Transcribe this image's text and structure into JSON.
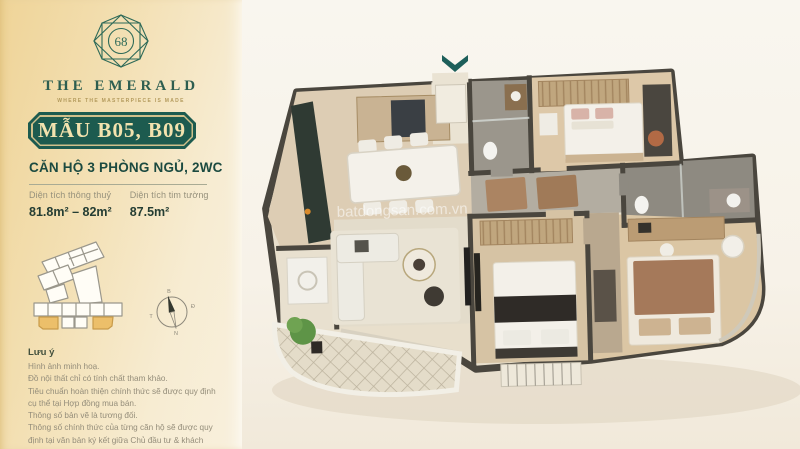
{
  "colors": {
    "emerald": "#1d5b4f",
    "plaque_text_gold": "#f2e2ae",
    "sidebar_gold": "#efd498",
    "unit_highlight_gold": "#ecbf6a",
    "wall_dark": "#4a463e",
    "entrance_arrow_teal": "#1d5f5a",
    "background_cream": "#f7f2e8"
  },
  "sidebar": {
    "logo": {
      "number": "68",
      "brand": "THE EMERALD",
      "tagline": "WHERE THE MASTERPIECE IS MADE"
    },
    "plaque_label": "MẪU B05, B09",
    "apartment_type": "CĂN HỘ 3 PHÒNG NGỦ, 2WC",
    "stats": [
      {
        "label": "Diện tích thông thuỷ",
        "value": "81.8m² – 82m²"
      },
      {
        "label": "Diện tích tim tường",
        "value": "87.5m²"
      }
    ],
    "compass": {
      "north": "B",
      "east": "Đ",
      "south": "N",
      "west": "T"
    },
    "notes": {
      "title": "Lưu ý",
      "lines": [
        "Hình ảnh minh hoạ.",
        "Đồ nội thất chỉ có tính chất tham khảo.",
        "Tiêu chuẩn hoàn thiện chính thức sẽ được quy định cụ thể tại Hợp đồng mua bán.",
        "Thông số bản vẽ là tương đối.",
        "Thông số chính thức của từng căn hộ sẽ được quy định tại văn bản ký kết giữa Chủ đầu tư & khách hàng."
      ]
    }
  },
  "floorplan": {
    "watermark": "batdongsan.com.vn"
  }
}
